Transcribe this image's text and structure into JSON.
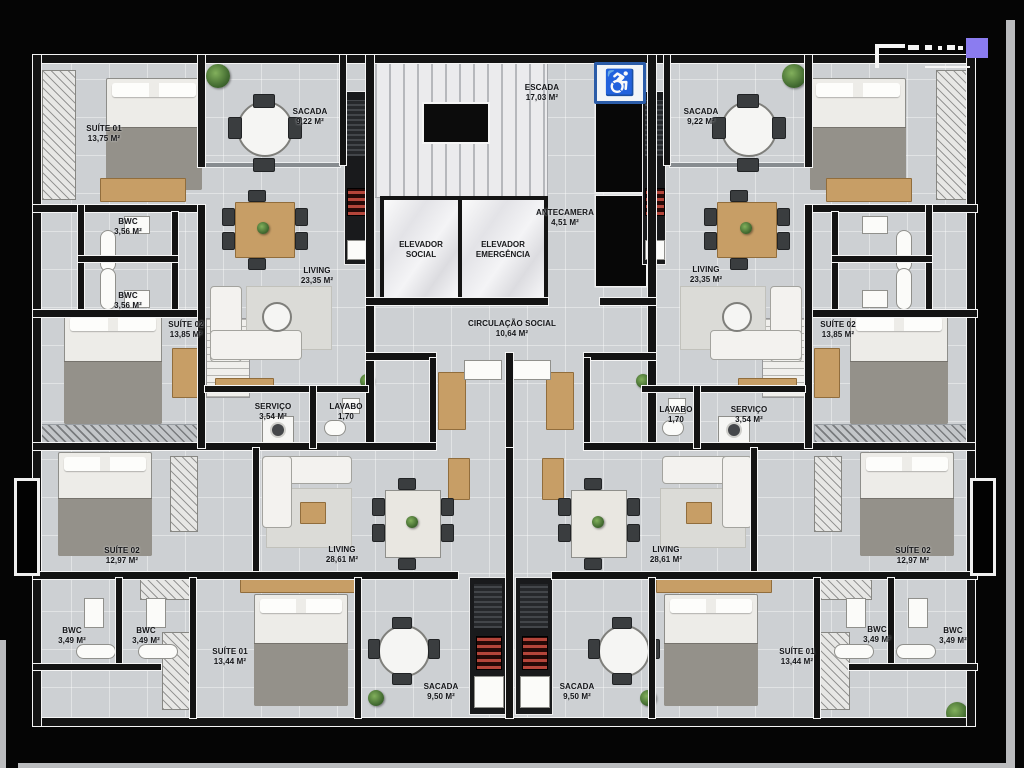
{
  "colors": {
    "background": "#050505",
    "floor": "#cdd0d3",
    "wall": "#131313",
    "wood_furniture": "#c79e66",
    "stove_red": "#b4453a",
    "accessibility_blue": "#2b5ca8",
    "logo_accent": "#8b7cf0"
  },
  "core": {
    "escada": {
      "name": "ESCADA",
      "area": "17,03 M²"
    },
    "antecamera": {
      "name": "ANTECAMERA",
      "area": "4,51 M²"
    },
    "elevador_social": {
      "name": "ELEVADOR SOCIAL"
    },
    "elevador_emergencia": {
      "name": "ELEVADOR EMERGÊNCIA"
    },
    "circulacao_social": {
      "name": "CIRCULAÇÃO SOCIAL",
      "area": "10,64 M²"
    },
    "accessibility_icon": "♿"
  },
  "rooms": [
    {
      "name": "SUÍTE 01",
      "area": "13,75 M²"
    },
    {
      "name": "SACADA",
      "area": "9,22 M²"
    },
    {
      "name": "BWC",
      "area": "3,56 M²"
    },
    {
      "name": "BWC",
      "area": "3,56 M²"
    },
    {
      "name": "SUÍTE 02",
      "area": "13,85 M²"
    },
    {
      "name": "LIVING",
      "area": "23,35 M²"
    },
    {
      "name": "SERVIÇO",
      "area": "3,54 M²"
    },
    {
      "name": "LAVABO",
      "area": "1,70"
    },
    {
      "name": "SACADA",
      "area": "9,22 M²"
    },
    {
      "name": "LIVING",
      "area": "23,35 M²"
    },
    {
      "name": "SUÍTE 02",
      "area": "13,85 M²"
    },
    {
      "name": "LAVABO",
      "area": "1,70"
    },
    {
      "name": "SERVIÇO",
      "area": "3,54 M²"
    },
    {
      "name": "SUÍTE 02",
      "area": "12,97 M²"
    },
    {
      "name": "LIVING",
      "area": "28,61 M²"
    },
    {
      "name": "BWC",
      "area": "3,49 M²"
    },
    {
      "name": "BWC",
      "area": "3,49 M²"
    },
    {
      "name": "SUÍTE 01",
      "area": "13,44 M²"
    },
    {
      "name": "SACADA",
      "area": "9,50 M²"
    },
    {
      "name": "SACADA",
      "area": "9,50 M²"
    },
    {
      "name": "LIVING",
      "area": "28,61 M²"
    },
    {
      "name": "SUÍTE 02",
      "area": "12,97 M²"
    },
    {
      "name": "SUÍTE 01",
      "area": "13,44 M²"
    },
    {
      "name": "BWC",
      "area": "3,49 M²"
    },
    {
      "name": "BWC",
      "area": "3,49 M²"
    }
  ]
}
